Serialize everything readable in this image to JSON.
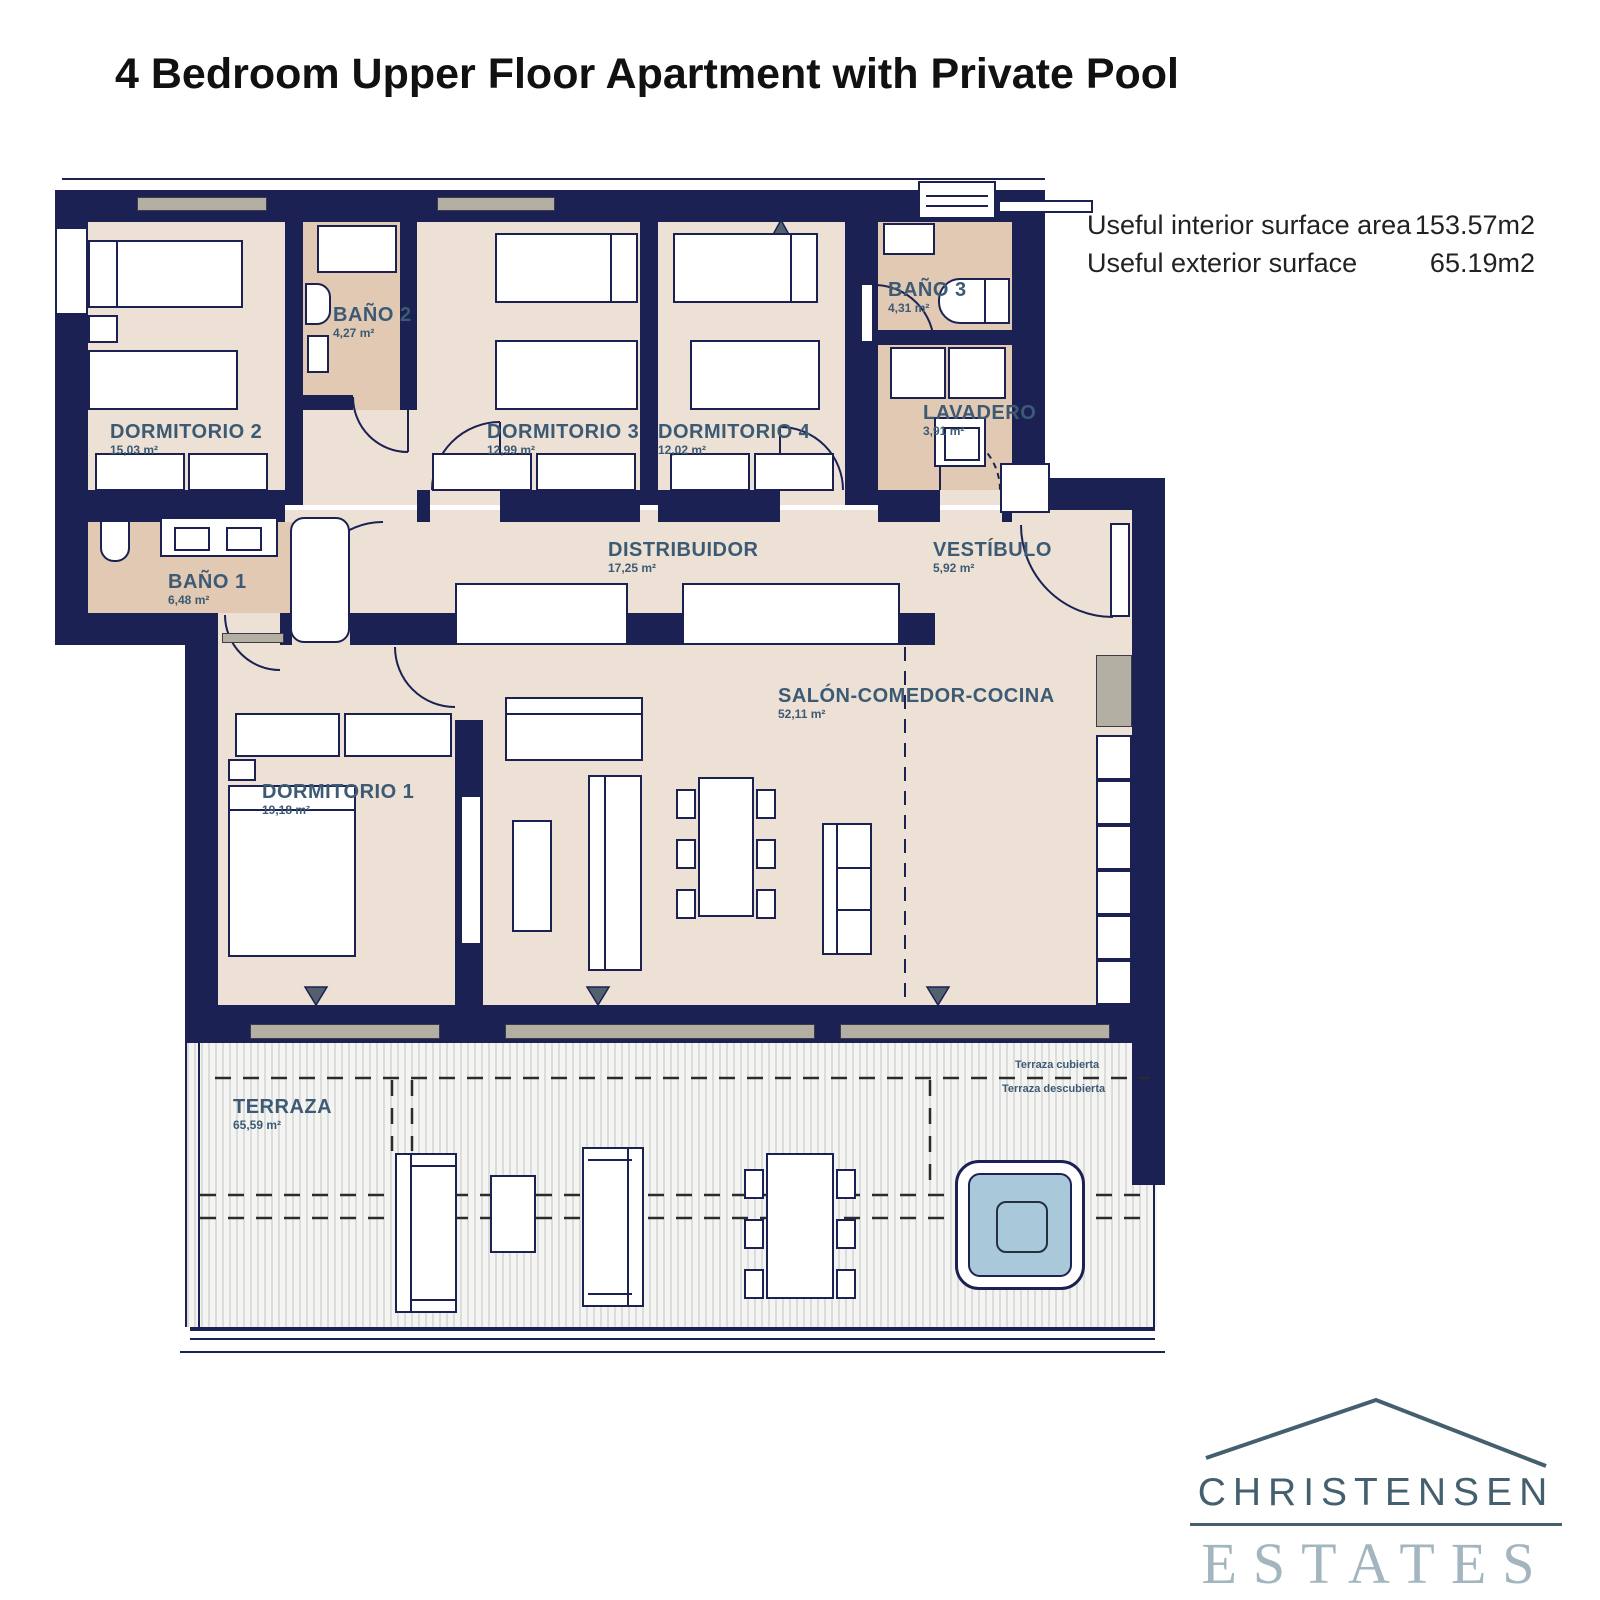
{
  "title": "4 Bedroom Upper Floor Apartment with Private Pool",
  "surface_info": {
    "rows": [
      {
        "label": "Useful interior surface area",
        "value": "153.57m2"
      },
      {
        "label": "Useful exterior surface",
        "value": "65.19m2"
      }
    ]
  },
  "rooms": {
    "dormitorio2": {
      "name": "DORMITORIO 2",
      "area": "15,03 m²"
    },
    "bano2": {
      "name": "BAÑO 2",
      "area": "4,27 m²"
    },
    "dormitorio3": {
      "name": "DORMITORIO 3",
      "area": "12,99 m²"
    },
    "dormitorio4": {
      "name": "DORMITORIO 4",
      "area": "12,02 m²"
    },
    "bano3": {
      "name": "BAÑO 3",
      "area": "4,31 m²"
    },
    "lavadero": {
      "name": "LAVADERO",
      "area": "3,91 m²"
    },
    "distribuidor": {
      "name": "DISTRIBUIDOR",
      "area": "17,25 m²"
    },
    "vestibulo": {
      "name": "VESTÍBULO",
      "area": "5,92 m²"
    },
    "bano1": {
      "name": "BAÑO 1",
      "area": "6,48 m²"
    },
    "dormitorio1": {
      "name": "DORMITORIO 1",
      "area": "19,18 m²"
    },
    "salon": {
      "name": "SALÓN-COMEDOR-COCINA",
      "area": "52,11 m²"
    },
    "terraza": {
      "name": "TERRAZA",
      "area": "65,59 m²"
    }
  },
  "terrace_annotations": {
    "covered": "Terraza cubierta",
    "uncovered": "Terraza descubierta"
  },
  "logo": {
    "name": "CHRISTENSEN",
    "type": "ESTATES"
  },
  "colors": {
    "wall": "#1b2153",
    "floor": "#ece1d4",
    "wet_floor": "#e2c9b3",
    "pool_water": "#a9c8d9",
    "label_text": "#3d5a74",
    "logo_primary": "#44606e",
    "logo_secondary": "#a3b5bf"
  }
}
